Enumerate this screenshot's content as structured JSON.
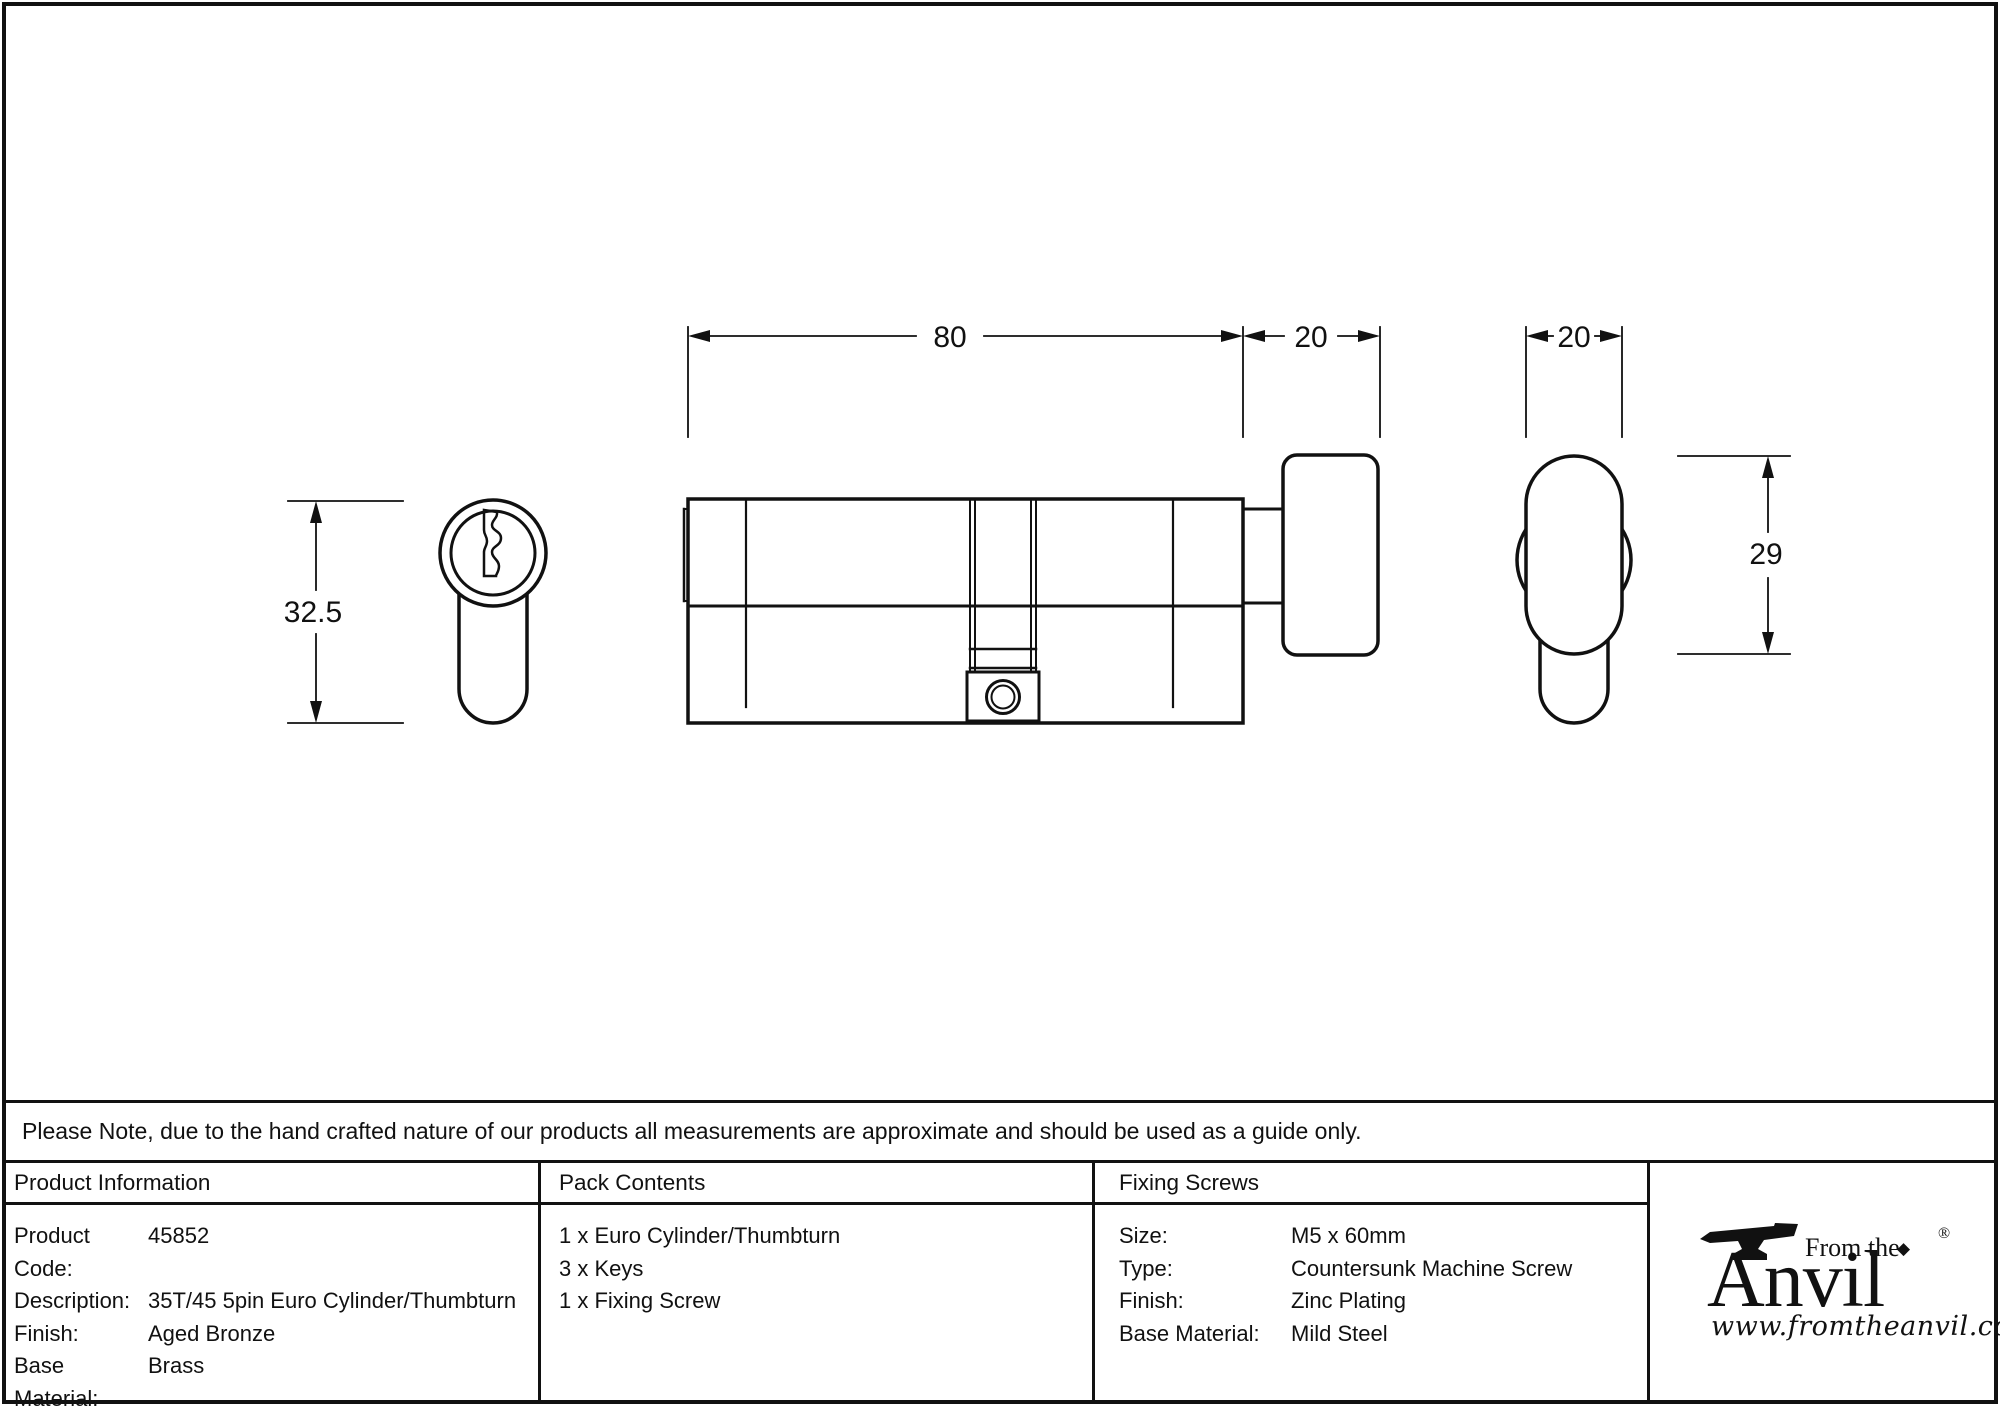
{
  "drawing": {
    "dims": {
      "total_length": "80",
      "thumbturn_depth": "20",
      "thumbturn_width": "20",
      "thumbturn_height": "29",
      "body_height": "32.5"
    }
  },
  "note": {
    "text": "Please Note, due to the hand crafted nature of our products all measurements are approximate and should be used as a guide only."
  },
  "table": {
    "product_information": {
      "header": "Product Information",
      "rows": [
        {
          "label": "Product Code:",
          "value": "45852"
        },
        {
          "label": "Description:",
          "value": "35T/45 5pin Euro Cylinder/Thumbturn"
        },
        {
          "label": "Finish:",
          "value": "Aged Bronze"
        },
        {
          "label": "Base Material:",
          "value": "Brass"
        }
      ]
    },
    "pack_contents": {
      "header": "Pack Contents",
      "items": [
        "1 x Euro Cylinder/Thumbturn",
        "3 x Keys",
        "1 x Fixing Screw"
      ]
    },
    "fixing_screws": {
      "header": "Fixing Screws",
      "rows": [
        {
          "label": "Size:",
          "value": "M5 x 60mm"
        },
        {
          "label": "Type:",
          "value": "Countersunk Machine Screw"
        },
        {
          "label": "Finish:",
          "value": "Zinc Plating"
        },
        {
          "label": "Base Material:",
          "value": "Mild Steel"
        }
      ]
    }
  },
  "logo": {
    "tagline": "From the",
    "name": "Anvil",
    "registered": "®",
    "diamond": "◆",
    "url": "www.fromtheanvil.co.uk"
  },
  "colors": {
    "line": "#111111",
    "background": "#ffffff"
  }
}
